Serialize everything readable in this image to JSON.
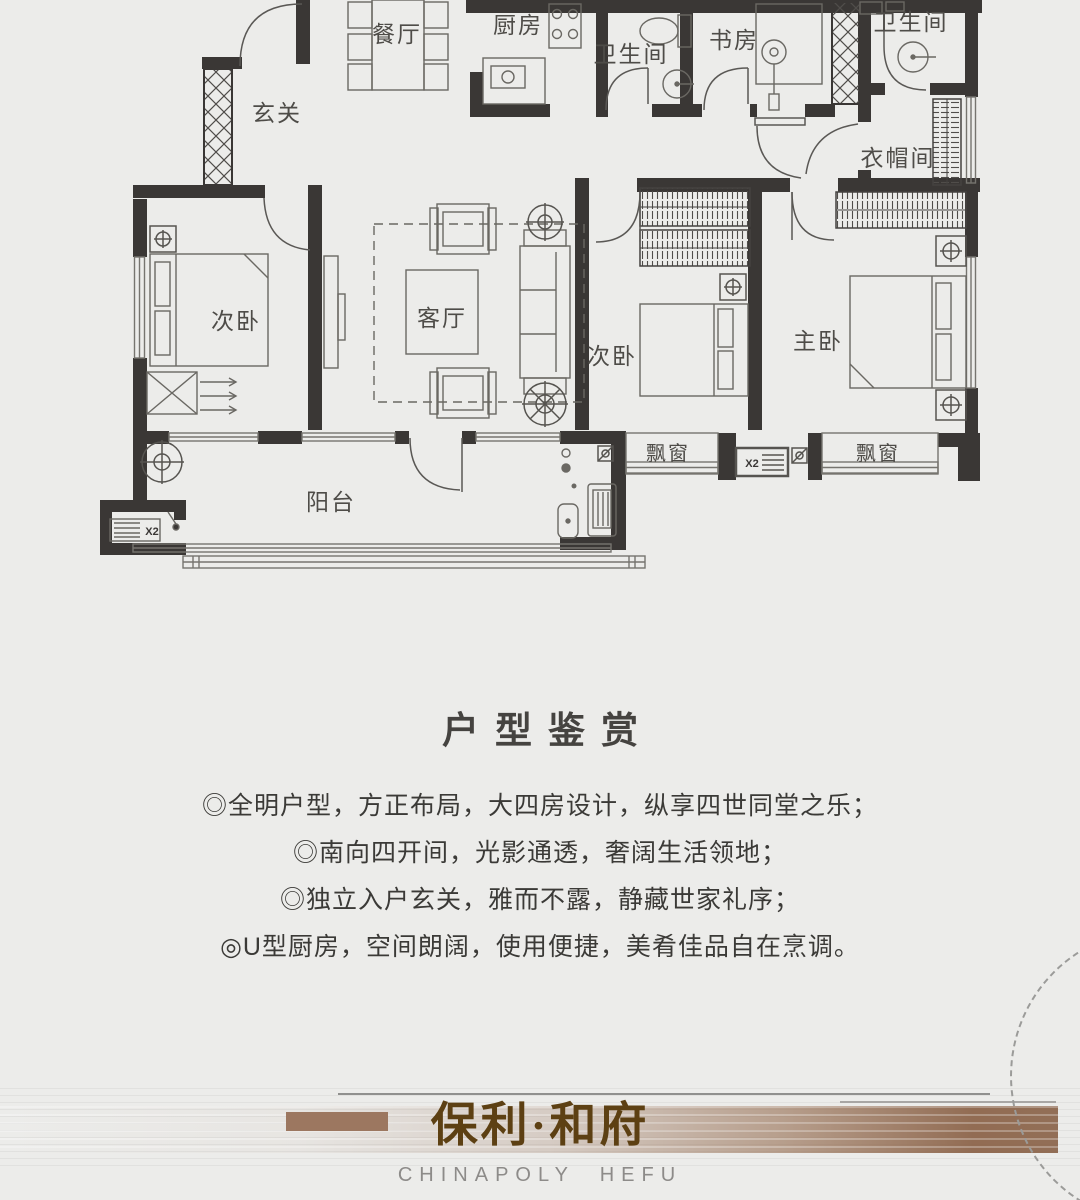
{
  "plan": {
    "labels": {
      "dining": "餐厅",
      "kitchen": "厨房",
      "bath_top": "卫生间",
      "study": "书房",
      "bath_right": "卫生间",
      "cloakroom": "衣帽间",
      "foyer": "玄关",
      "bedroom_left": "次卧",
      "living": "客厅",
      "bedroom_middle": "次卧",
      "master": "主卧",
      "bay_left": "飘窗",
      "bay_right": "飘窗",
      "balcony": "阳台",
      "x2_washer": "X2",
      "x2_middle": "X2"
    }
  },
  "appreciation": {
    "title": "户型鉴赏",
    "bullets": [
      "◎全明户型，方正布局，大四房设计，纵享四世同堂之乐；",
      "◎南向四开间，光影通透，奢阔生活领地；",
      "◎独立入户玄关，雅而不露，静藏世家礼序；",
      "◎U型厨房，空间朗阔，使用便捷，美肴佳品自在烹调。"
    ]
  },
  "brand": {
    "name": "保利·和府",
    "subtitle": "CHINAPOLY  HEFU"
  },
  "colors": {
    "background": "#ECECEA",
    "wall": "#3A3735",
    "plan_line": "#6A6A6A",
    "brand_brown": "#9C7760",
    "brand_text": "#5D4013",
    "subtitle_gray": "#8D8B89"
  }
}
